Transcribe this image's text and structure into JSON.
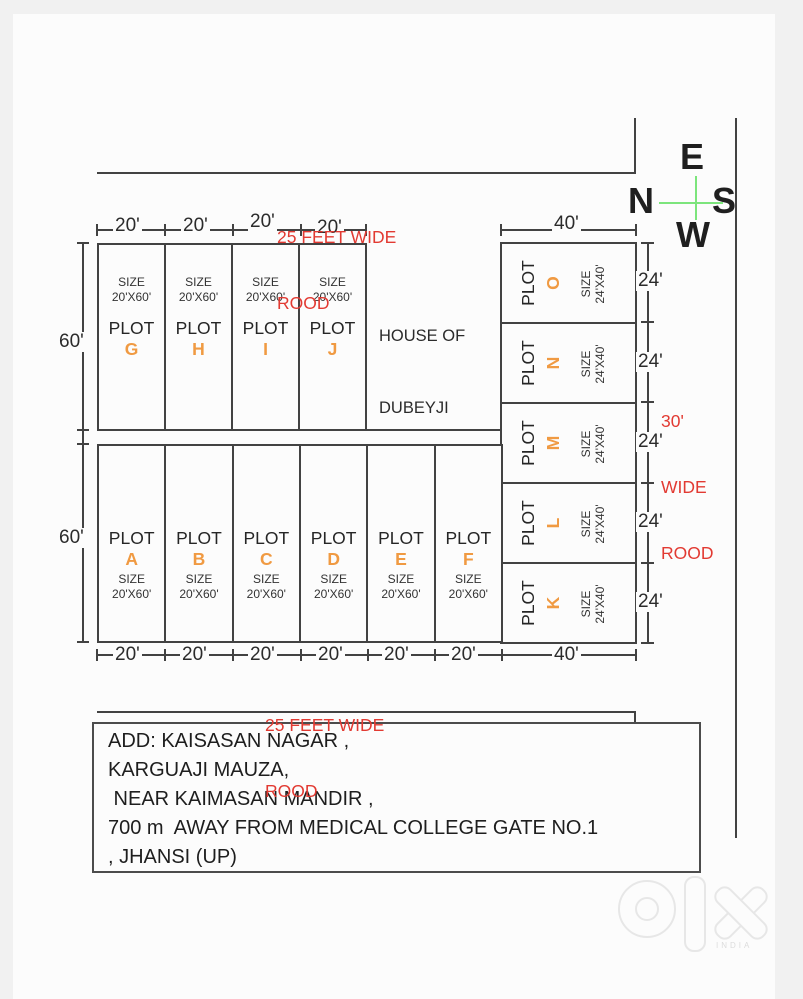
{
  "compass": {
    "top": "E",
    "left": "N",
    "right": "S",
    "bottom": "W"
  },
  "top_road_label": {
    "line1": "25 FEET WIDE",
    "line2": "ROOD"
  },
  "bottom_road_label": {
    "line1": "25 FEET WIDE",
    "line2": "ROOD"
  },
  "right_road_label": {
    "line1": "30'",
    "line2": "WIDE",
    "line3": "ROOD"
  },
  "house_label": {
    "line1": "HOUSE OF",
    "line2": "DUBEYJI"
  },
  "dims": {
    "top": [
      "20'",
      "20'",
      "20'",
      "20'"
    ],
    "top_right": "40'",
    "left": [
      "60'",
      "60'"
    ],
    "right": [
      "24'",
      "24'",
      "24'",
      "24'",
      "24'"
    ],
    "bottom": [
      "20'",
      "20'",
      "20'",
      "20'",
      "20'",
      "20'",
      "40'"
    ]
  },
  "plots_top": [
    {
      "word": "PLOT",
      "letter": "G",
      "size_label": "SIZE",
      "size_value": "20'X60'"
    },
    {
      "word": "PLOT",
      "letter": "H",
      "size_label": "SIZE",
      "size_value": "20'X60'"
    },
    {
      "word": "PLOT",
      "letter": "I",
      "size_label": "SIZE",
      "size_value": "20'X60'"
    },
    {
      "word": "PLOT",
      "letter": "J",
      "size_label": "SIZE",
      "size_value": "20'X60'"
    }
  ],
  "plots_bottom": [
    {
      "word": "PLOT",
      "letter": "A",
      "size_label": "SIZE",
      "size_value": "20'X60'"
    },
    {
      "word": "PLOT",
      "letter": "B",
      "size_label": "SIZE",
      "size_value": "20'X60'"
    },
    {
      "word": "PLOT",
      "letter": "C",
      "size_label": "SIZE",
      "size_value": "20'X60'"
    },
    {
      "word": "PLOT",
      "letter": "D",
      "size_label": "SIZE",
      "size_value": "20'X60'"
    },
    {
      "word": "PLOT",
      "letter": "E",
      "size_label": "SIZE",
      "size_value": "20'X60'"
    },
    {
      "word": "PLOT",
      "letter": "F",
      "size_label": "SIZE",
      "size_value": "20'X60'"
    }
  ],
  "plots_right": [
    {
      "word": "PLOT",
      "letter": "O",
      "size_label": "SIZE",
      "size_value": "24'X40'"
    },
    {
      "word": "PLOT",
      "letter": "N",
      "size_label": "SIZE",
      "size_value": "24'X40'"
    },
    {
      "word": "PLOT",
      "letter": "M",
      "size_label": "SIZE",
      "size_value": "24'X40'"
    },
    {
      "word": "PLOT",
      "letter": "L",
      "size_label": "SIZE",
      "size_value": "24'X40'"
    },
    {
      "word": "PLOT",
      "letter": "K",
      "size_label": "SIZE",
      "size_value": "24'X40'"
    }
  ],
  "address": {
    "lines": [
      "ADD: KAISASAN NAGAR ,",
      "KARGUAJI MAUZA,",
      " NEAR KAIMASAN MANDIR ,",
      "700 m  AWAY FROM MEDICAL COLLEGE GATE NO.1",
      ", JHANSI (UP)"
    ]
  },
  "watermark": {
    "brand": "olx",
    "country": "INDIA"
  },
  "colors": {
    "accent_orange": "#f09a42",
    "road_red": "#e23a32",
    "compass_green": "#7ce57c",
    "line": "#424242",
    "page_margin": "#f1f1f1",
    "paper": "#fcfcfc"
  }
}
